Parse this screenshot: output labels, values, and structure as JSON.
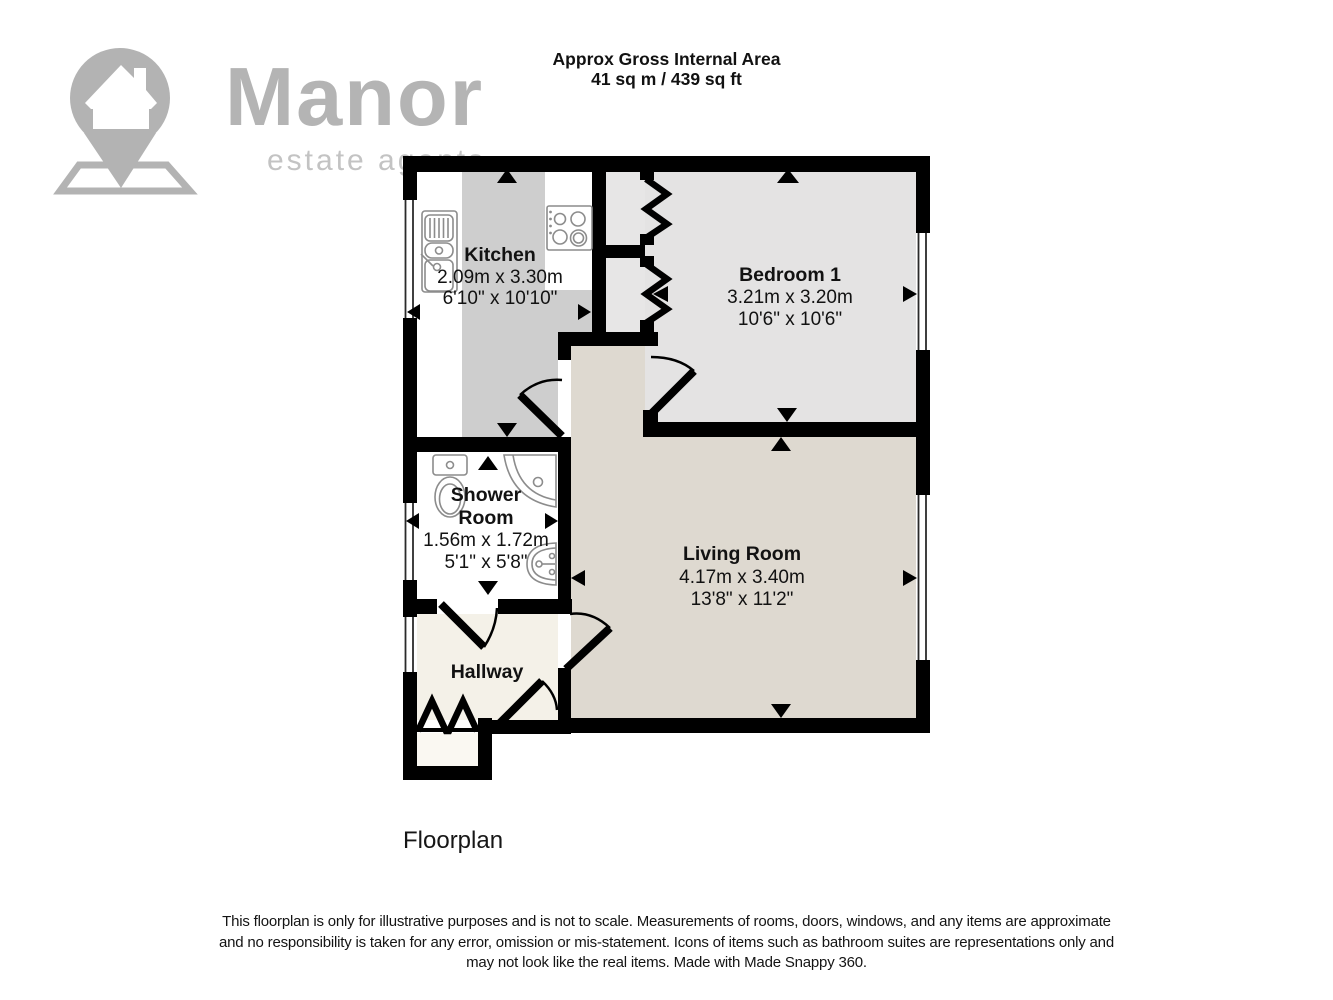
{
  "header": {
    "title": "Approx Gross Internal Area",
    "area": "41 sq m / 439 sq ft"
  },
  "logo": {
    "brand": "Manor",
    "tagline": "estate agents"
  },
  "rooms": {
    "kitchen": {
      "name": "Kitchen",
      "metric": "2.09m x 3.30m",
      "imperial": "6'10\" x 10'10\""
    },
    "bedroom1": {
      "name": "Bedroom 1",
      "metric": "3.21m x 3.20m",
      "imperial": "10'6\" x 10'6\""
    },
    "shower": {
      "name_line1": "Shower",
      "name_line2": "Room",
      "metric": "1.56m x 1.72m",
      "imperial": "5'1\" x 5'8\""
    },
    "living": {
      "name": "Living Room",
      "metric": "4.17m x 3.40m",
      "imperial": "13'8\" x 11'2\""
    },
    "hallway": {
      "name": "Hallway"
    }
  },
  "footer": {
    "caption": "Floorplan",
    "disclaimer_line1": "This floorplan is only for illustrative purposes and is not to scale. Measurements of rooms, doors, windows, and any items are approximate",
    "disclaimer_line2": "and no responsibility is taken for any error, omission or mis-statement. Icons of items such as bathroom suites are representations only and",
    "disclaimer_line3": "may not look like the real items. Made with Made Snappy 360."
  },
  "colors": {
    "wall": "#000000",
    "bedroom_floor": "#e4e3e3",
    "kitchen_floor_strip": "#cecece",
    "living_floor": "#ded9d0",
    "hallway_floor": "#f4f1e8",
    "logo_gray": "#b3b3b3"
  }
}
